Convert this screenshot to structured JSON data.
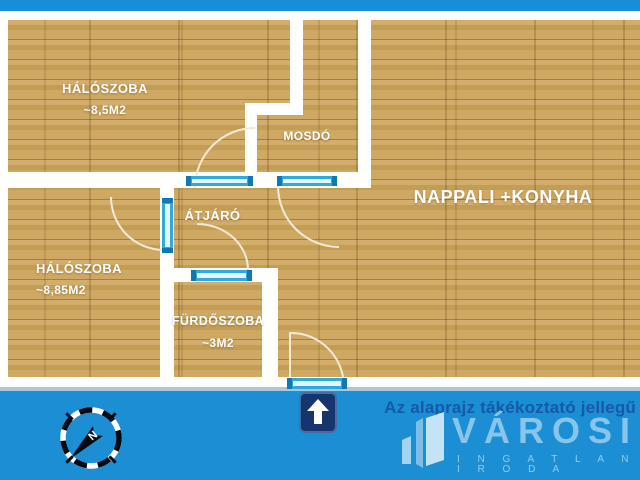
{
  "rooms": {
    "haloszoba_top": {
      "name": "HÁLÓSZOBA",
      "area": "~8,5M2"
    },
    "mosdo": {
      "name": "MOSDÓ",
      "area": ""
    },
    "atjaro": {
      "name": "ÁTJÁRÓ",
      "area": ""
    },
    "haloszoba_bottom": {
      "name": "HÁLÓSZOBA",
      "area": "~8,85M2"
    },
    "furdoszoba": {
      "name": "FÜRDŐSZOBA",
      "area": "~3M2"
    },
    "nappali": {
      "name": "NAPPALI +KONYHA",
      "area": ""
    }
  },
  "footer": {
    "disclaimer": "Az alaprajz tákékoztató jellegű",
    "brand": "VÁROSI",
    "brand_sub": "I N G A T L A N I R O D A",
    "compass_label": "N"
  },
  "icons": {
    "compass": "compass-icon",
    "entrance_arrow": "up-arrow-icon",
    "brand_buildings": "buildings-logo-icon"
  },
  "colors": {
    "band_blue": "#1b8ed4",
    "wall_white": "#ffffff",
    "door_blue": "#2fa9e0",
    "door_cap_blue": "#0f79b2",
    "wood_base": "#c9a25c",
    "disclaimer_blue": "#1659a6",
    "arrow_navy": "#16356e",
    "brand_text": "rgba(226,243,251,0.55)"
  }
}
